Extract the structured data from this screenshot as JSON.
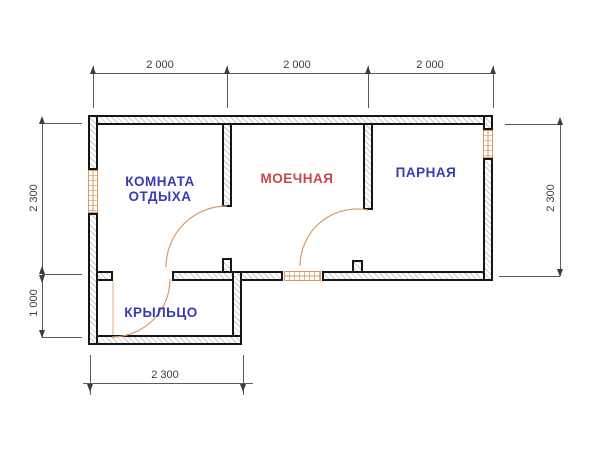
{
  "rooms": {
    "rest": {
      "line1": "КОМНАТА",
      "line2": "ОТДЫХА"
    },
    "washing": {
      "label": "МОЕЧНАЯ"
    },
    "steam": {
      "label": "ПАРНАЯ"
    },
    "porch": {
      "label": "КРЫЛЬЦО"
    }
  },
  "dimensions": {
    "top": {
      "d1": "2 000",
      "d2": "2 000",
      "d3": "2 000"
    },
    "left": {
      "upper": "2 300",
      "lower": "1 000"
    },
    "right": {
      "value": "2 300"
    },
    "bottom": {
      "value": "2 300"
    }
  },
  "colors": {
    "wall": "#161616",
    "joinery_orange": "#d89a62",
    "label_blue": "#3a3ab4",
    "label_red": "#c9474b",
    "dimension_gray": "#3c3c3c"
  }
}
